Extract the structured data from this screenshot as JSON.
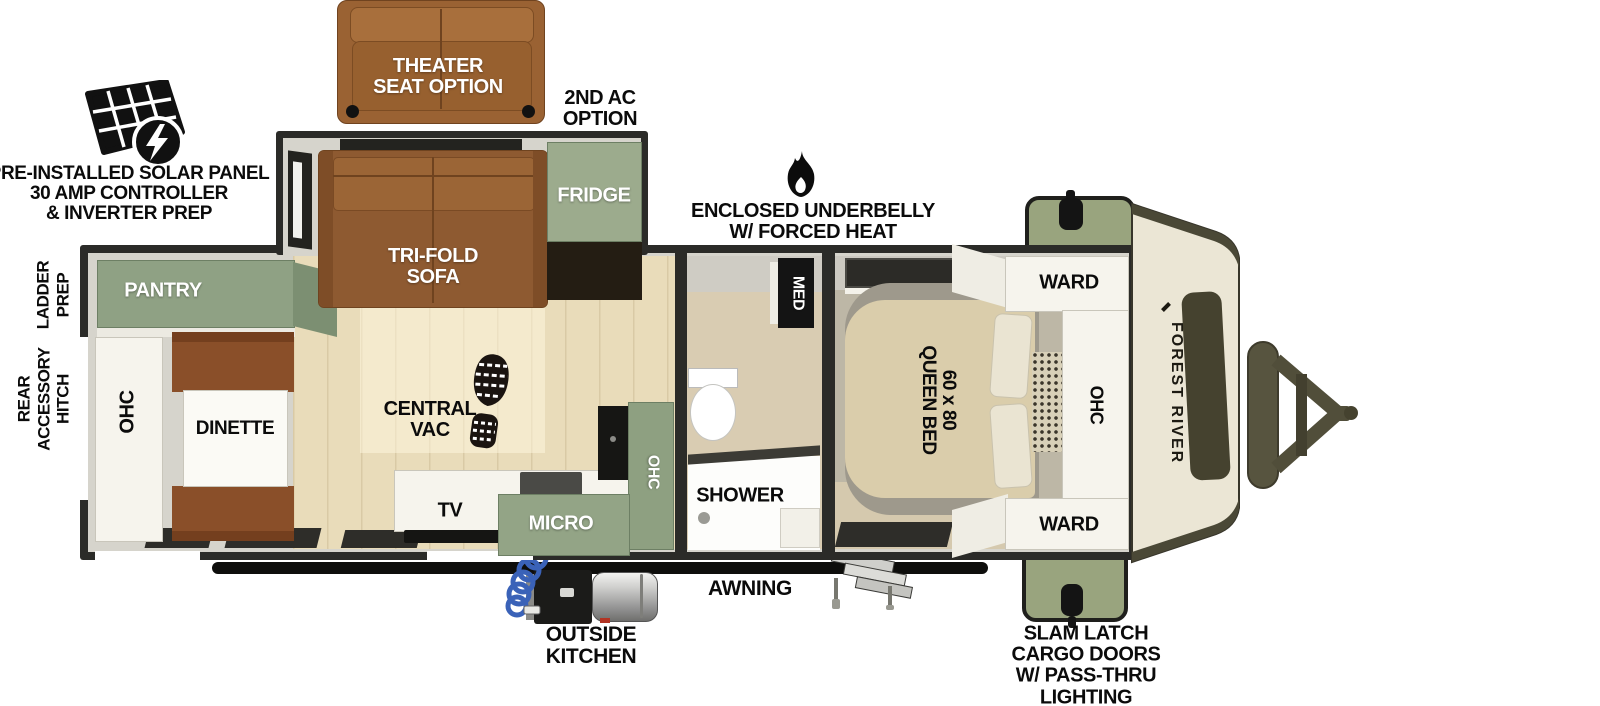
{
  "annotations": {
    "solar": [
      "PRE-INSTALLED SOLAR PANEL",
      "30 AMP CONTROLLER",
      "& INVERTER PREP"
    ],
    "theater_seat": [
      "THEATER",
      "SEAT OPTION"
    ],
    "second_ac": [
      "2ND AC",
      "OPTION"
    ],
    "underbelly": [
      "ENCLOSED UNDERBELLY",
      "W/ FORCED HEAT"
    ],
    "ladder_prep": [
      "LADDER",
      "PREP"
    ],
    "rear_hitch": [
      "REAR",
      "ACCESSORY",
      "HITCH"
    ],
    "awning": "AWNING",
    "outside_kitchen": [
      "OUTSIDE",
      "KITCHEN"
    ],
    "slam_latch": [
      "SLAM LATCH",
      "CARGO DOORS",
      "W/ PASS-THRU",
      "LIGHTING"
    ]
  },
  "rooms": {
    "pantry": "PANTRY",
    "ohc_rear": "OHC",
    "dinette": "DINETTE",
    "tri_fold_sofa": [
      "TRI-FOLD",
      "SOFA"
    ],
    "fridge": "FRIDGE",
    "central_vac": [
      "CENTRAL",
      "VAC"
    ],
    "tv": "TV",
    "micro": "MICRO",
    "ohc_kitchen": "OHC",
    "shower": "SHOWER",
    "med": "MED",
    "queen_bed": [
      "60 x 80",
      "QUEEN BED"
    ],
    "ward_front_top": "WARD",
    "ohc_bedroom": "OHC",
    "ward_front_bottom": "WARD"
  },
  "brand": {
    "name": "FOREST RIVER"
  },
  "icons": {
    "solar_panel": "solar-panel-icon",
    "lightning_bolt": "lightning-bolt-icon",
    "flame": "flame-icon",
    "boot_print": "boot-print-icon",
    "emblem": "forest-river-emblem"
  },
  "colors": {
    "wall": "#2b2b28",
    "cabinet_green": "#93a486",
    "cargo_green": "#99a47e",
    "sofa_brown": "#8e5a31",
    "theater_brown": "#9a6233",
    "bench_brown": "#8a4f29",
    "wood_floor": "#e9dcba",
    "bedroom_floor": "#bdb7a6",
    "bath_floor": "#d9ccb2",
    "bed_tan": "#dacdab",
    "front_cap_cream": "#ebe6d5",
    "cap_window": "#45422f",
    "white_cabinet": "#f6f4ed",
    "hitch": "#56533e",
    "hose_blue": "#3a62b8"
  }
}
